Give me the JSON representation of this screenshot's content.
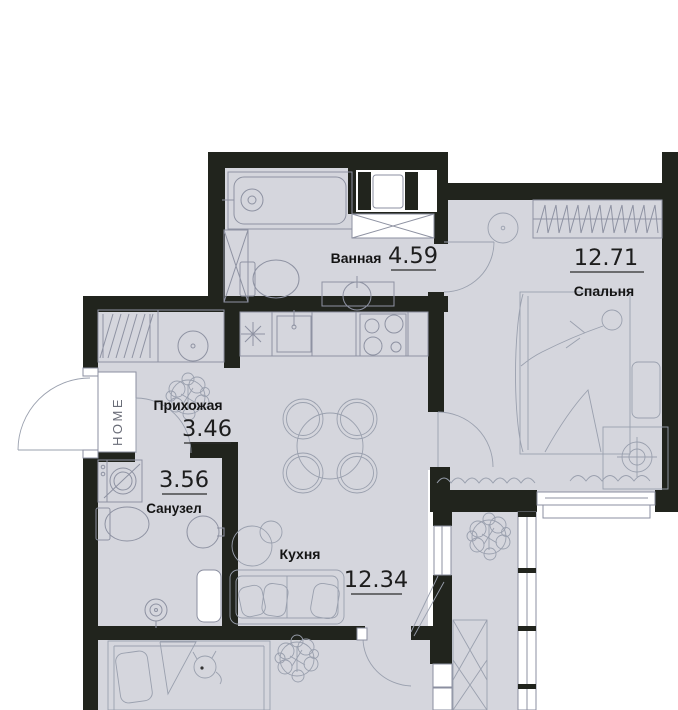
{
  "plan": {
    "title": "apartment-floor-plan",
    "rooms": [
      {
        "id": "bathroom",
        "name": "Ванная",
        "area": "4.59"
      },
      {
        "id": "bedroom",
        "name": "Спальня",
        "area": "12.71"
      },
      {
        "id": "hallway",
        "name": "Прихожая",
        "area": "3.46"
      },
      {
        "id": "wc",
        "name": "Санузел",
        "area": "3.56"
      },
      {
        "id": "kitchen",
        "name": "Кухня",
        "area": "12.34"
      }
    ],
    "doormat_text": "HOME",
    "colors": {
      "wall": "#21241d",
      "floor": "#d5d6dd",
      "furniture_line": "#8e92a2",
      "text": "#141414",
      "background": "#ffffff"
    }
  }
}
